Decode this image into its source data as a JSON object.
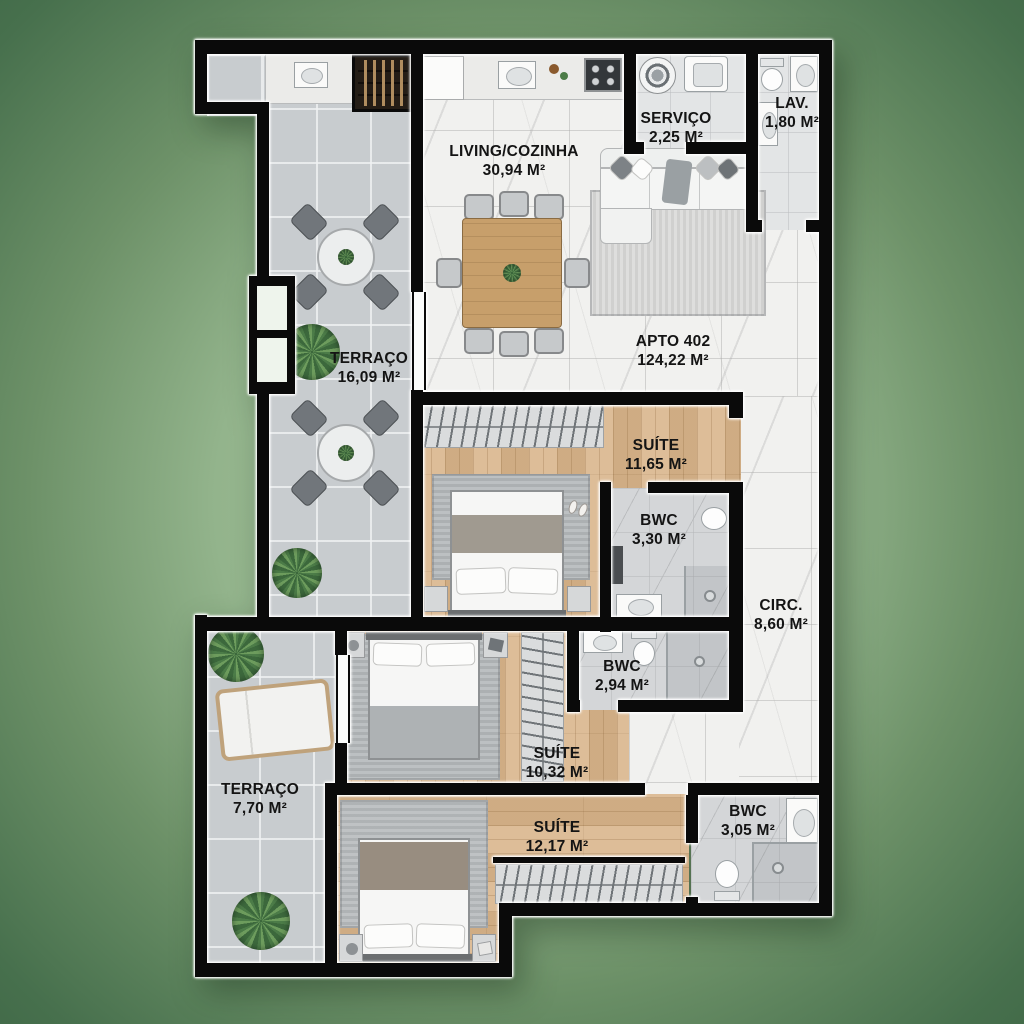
{
  "title": "Floor plan APTO 402",
  "apartment": {
    "name": "APTO 402",
    "area": "124,22 M²"
  },
  "rooms": [
    {
      "id": "living",
      "name": "LIVING/COZINHA",
      "area": "30,94 M²"
    },
    {
      "id": "servico",
      "name": "SERVIÇO",
      "area": "2,25 M²"
    },
    {
      "id": "lav",
      "name": "LAV.",
      "area": "1,80 M²"
    },
    {
      "id": "terraco-1",
      "name": "TERRAÇO",
      "area": "16,09 M²"
    },
    {
      "id": "suite-1",
      "name": "SUÍTE",
      "area": "11,65 M²"
    },
    {
      "id": "bwc-1",
      "name": "BWC",
      "area": "3,30 M²"
    },
    {
      "id": "circ",
      "name": "CIRC.",
      "area": "8,60 M²"
    },
    {
      "id": "bwc-2",
      "name": "BWC",
      "area": "2,94 M²"
    },
    {
      "id": "suite-2",
      "name": "SUÍTE",
      "area": "10,32 M²"
    },
    {
      "id": "terraco-2",
      "name": "TERRAÇO",
      "area": "7,70 M²"
    },
    {
      "id": "suite-3",
      "name": "SUÍTE",
      "area": "12,17 M²"
    },
    {
      "id": "bwc-3",
      "name": "BWC",
      "area": "3,05 M²"
    }
  ],
  "colors": {
    "background_green": "#47704d",
    "wall_black": "#0a0a0a",
    "wall_outline_white": "#ffffff",
    "floor_marble": "#f1f1ef",
    "floor_terrace_tile": "#c8cccf",
    "floor_wood": "#d9b68c",
    "floor_bathroom": "#d4d6d8"
  }
}
